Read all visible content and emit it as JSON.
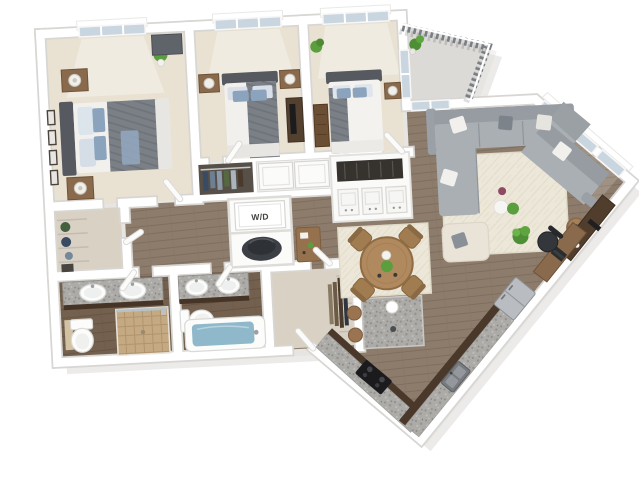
{
  "page": {
    "background": "#ffffff",
    "type": "3d-floor-plan-render"
  },
  "labels": {
    "washer_dryer": "W/D"
  },
  "palette": {
    "wall": "#ffffff",
    "wall_shadow": "#d8d6d3",
    "floor_wood": "#8d7c6c",
    "floor_wood_dark": "#74604e",
    "carpet": "#e9e2d3",
    "rug": "#ece7d9",
    "granite": "#adaba7",
    "cabinet_dark": "#4a392a",
    "sofa": "#a9afb3",
    "bed_duvet_gray": "#7b8087",
    "pillow_blue": "#8ba3bd",
    "wood_furniture": "#8a6a4c",
    "plant_green": "#5a9e3d",
    "tub_water": "#8fb9cb",
    "appliance_steel": "#b9bdc1",
    "tile_tan": "#c4a982",
    "window_glass": "#c9d5df",
    "drop_shadow": "#d5d2ce"
  },
  "scene": {
    "view": "isometric top-down 3D apartment floor plan, slightly rotated, on white background",
    "rooms": [
      "bedroom-1",
      "bedroom-2",
      "bedroom-3",
      "master-closet",
      "master-bathroom",
      "bathroom-2",
      "walk-in-closet",
      "laundry-closet",
      "hallway",
      "living-room",
      "dining-area",
      "kitchen",
      "balcony",
      "entry"
    ],
    "furniture": [
      "bed-with-gray-blue-bedding",
      "nightstands-with-lamps",
      "dressers",
      "wall-art-frames",
      "potted-plants",
      "sectional-sofa",
      "cream-area-rugs",
      "ottoman-armchair",
      "side-table",
      "media-console",
      "desk-with-office-chair",
      "round-dining-table-with-4-chairs",
      "kitchen-island-with-stools",
      "l-shaped-granite-counter",
      "cooktop",
      "double-basin-sink",
      "refrigerator",
      "washer-dryer",
      "water-heater",
      "double-sink-vanities",
      "toilets",
      "walk-in-shower",
      "bathtub",
      "wire-closet-shelving",
      "balcony-railing"
    ]
  }
}
